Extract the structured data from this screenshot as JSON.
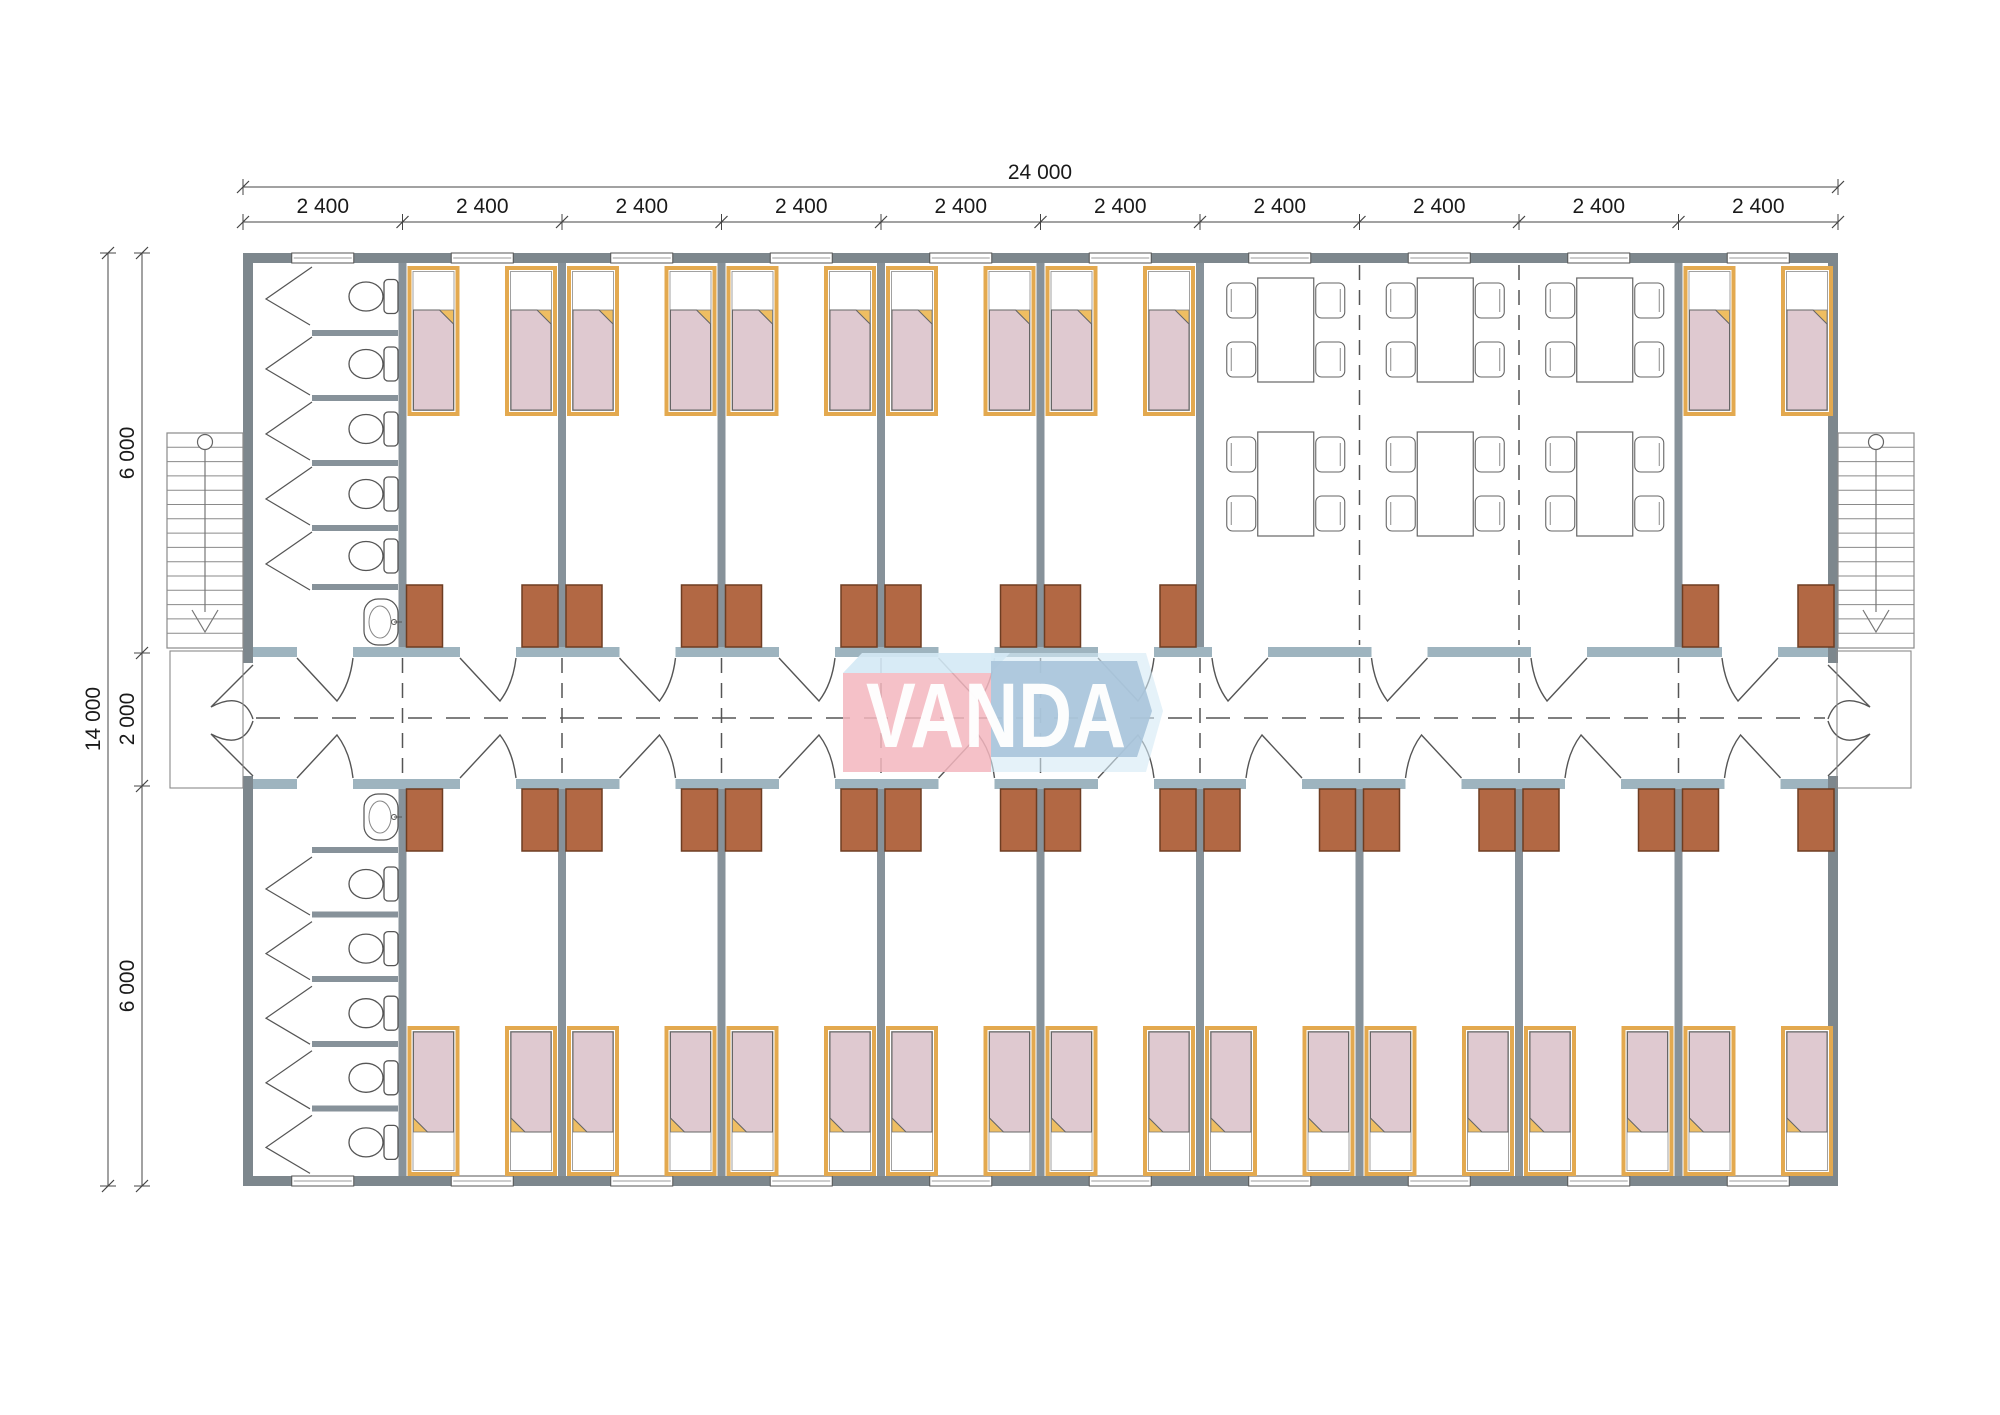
{
  "dimensions": {
    "top_total_label": "24 000",
    "top_segment_labels": [
      "2 400",
      "2 400",
      "2 400",
      "2 400",
      "2 400",
      "2 400",
      "2 400",
      "2 400",
      "2 400",
      "2 400"
    ],
    "left_total_label": "14 000",
    "left_segment_labels": [
      "6 000",
      "2 000",
      "6 000"
    ]
  },
  "logo": {
    "text": "VANDA",
    "pink": "#F3B6BE",
    "blue": "#A9C4DA",
    "light_blue": "#D4E9F5",
    "text_color": "#FFFFFF"
  },
  "colors": {
    "background": "#FFFFFF",
    "exterior_wall": "#7D878D",
    "partition_wall": "#87929A",
    "corridor_wall": "#9EB4BF",
    "dash_line": "#555555",
    "door_line": "#555555",
    "furniture_line": "#555555",
    "bed_frame": "#E3A94F",
    "bed_blanket": "#DFC9D0",
    "bed_fold": "#EFBE62",
    "wardrobe_fill": "#B26844",
    "wardrobe_border": "#6E3D22",
    "stair_line": "#8A8A8A",
    "dimension_line": "#444444"
  },
  "inventory": {
    "bedrooms_top_row": 5,
    "bedrooms_bottom_row": 9,
    "corner_bedroom_beds": 2,
    "single_beds_total": 30,
    "wardrobes_total": 30,
    "toilet_stalls": 10,
    "wash_basins": 2,
    "dining_tables": 6,
    "chairs_per_table": 4,
    "staircases": 2
  }
}
